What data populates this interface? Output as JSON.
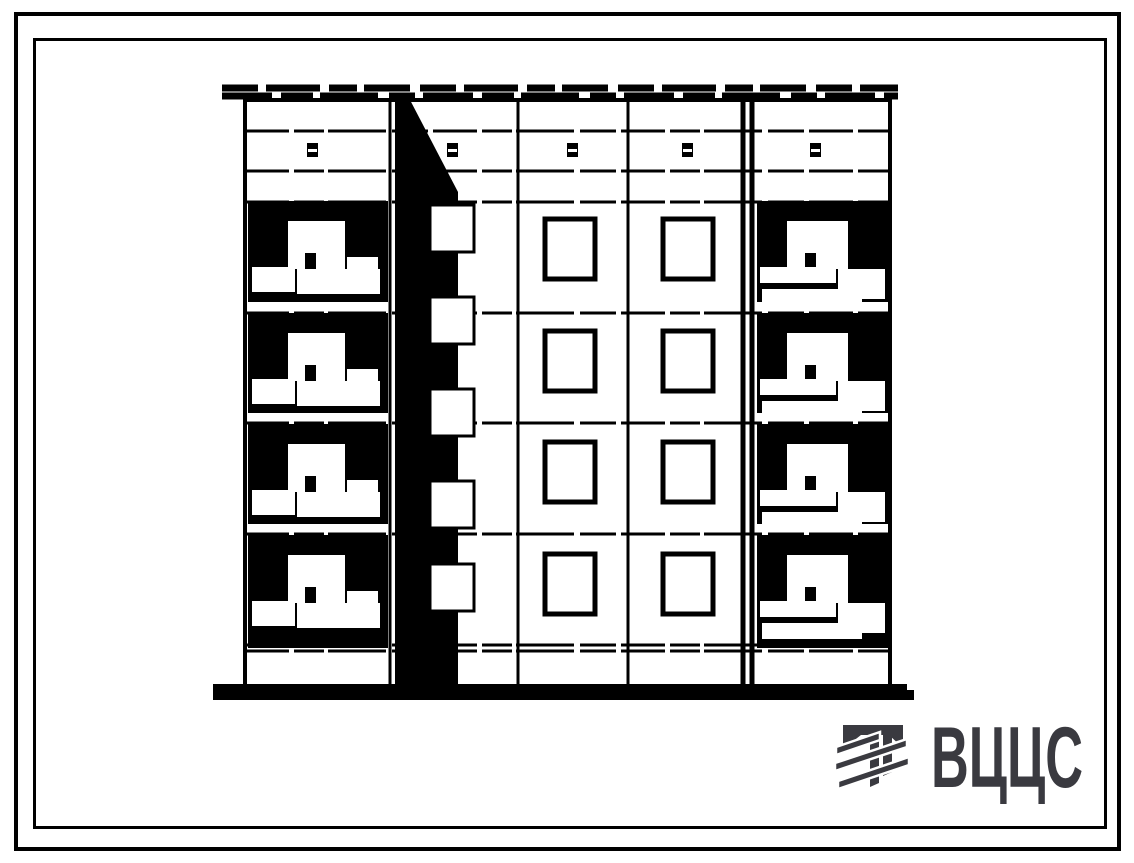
{
  "page": {
    "background": "#ffffff",
    "frame_color": "#000000"
  },
  "logo": {
    "text": "ВЦЦС",
    "color": "#3a3a40",
    "mark": "striped-tee-emblem"
  },
  "drawing": {
    "type": "building-elevation-drawing",
    "ink": "#000000",
    "paper": "#ffffff",
    "floors": 4,
    "facade": {
      "left": 245,
      "right": 890,
      "top": 100,
      "bottom": 686
    },
    "parapet": {
      "x1": 222,
      "x2": 898,
      "rows_y": [
        88,
        96
      ],
      "dashes": [
        "36 8 54 9 28 7 46 10",
        "50 9 32 7 58 11 26 8"
      ]
    },
    "attic_lines_y": [
      131,
      171
    ],
    "floor_lines_y": [
      202,
      313,
      423,
      534,
      645,
      651
    ],
    "line_dash": "44 5 30 4 58 6 36 5",
    "section_lines_x": [
      390,
      518,
      628
    ],
    "double_section_lines_x": [
      743,
      752
    ],
    "stair_stripe": {
      "left": 395,
      "right": 458,
      "top": 98,
      "wedge_right_top": 409,
      "wedge_bottom": 192,
      "bottom": 684
    },
    "stair_windows": {
      "x": 430,
      "w": 44,
      "h": 47,
      "tops": [
        205,
        297,
        389,
        481,
        564
      ]
    },
    "middle_windows": {
      "cols_x": [
        545,
        663
      ],
      "rows_y": [
        219,
        331,
        442,
        554
      ],
      "w": 50,
      "h": 60
    },
    "vents": {
      "centers_x": [
        312,
        452,
        572,
        687,
        815
      ],
      "y": 143
    },
    "balconies": {
      "tops": [
        201,
        313,
        424,
        535
      ],
      "heights": [
        101,
        100,
        100,
        113
      ],
      "left_x": 248,
      "left_w": 140,
      "right_x": 757,
      "right_w": 131
    },
    "ground_bar": {
      "x1": 213,
      "x2": 907,
      "y": 684,
      "h": 16,
      "nub_w": 9,
      "nub_h": 10
    }
  }
}
